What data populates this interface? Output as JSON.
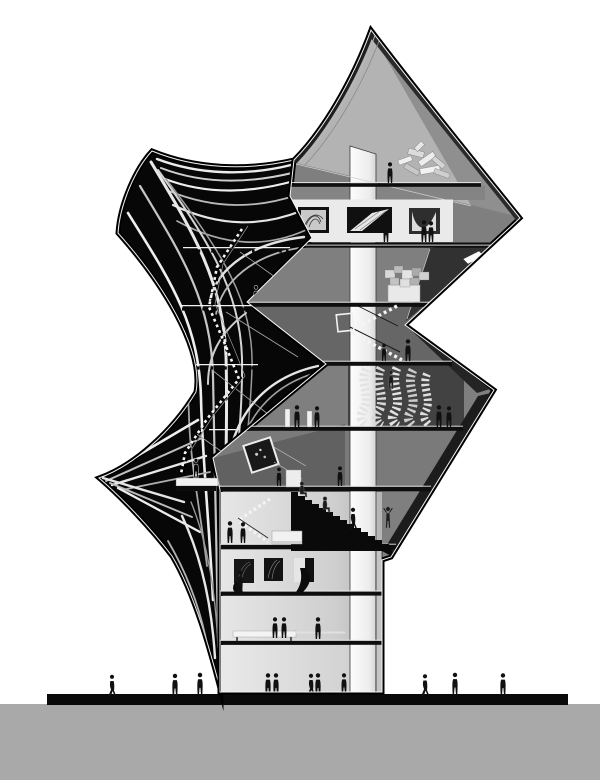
{
  "illustration": {
    "kind": "architectural-section",
    "style": "monochrome grayscale rendering",
    "building": "angular museum tower with draped cable canopy"
  },
  "palette": {
    "background": "#ffffff",
    "ground_plane": "#a9a9a9",
    "ground_line": "#0a0a0a",
    "canopy_fill": "#070707",
    "rib_light": "#e8e8e8",
    "volume_light_facet": "#b3b3b3",
    "volume_right_facet": "#8f8f8f",
    "gallery_band": "#eaeaea",
    "auditorium_bg": "#424242",
    "elevator_core": "#f7f7f7",
    "figure_ink": "#111111"
  },
  "scene": {
    "upper_volume_floors": [
      "roof sculpture gallery",
      "picture gallery with three framed works",
      "model display room",
      "switchback stair hall",
      "auditorium with waved seating rows",
      "installation room with tilted frame",
      "grand black stair"
    ],
    "tower_floors": [
      "stair lobby with reception desk",
      "small gallery with three dark artworks",
      "lounge with bench",
      "ground level hall"
    ],
    "artworks_in_band": 3,
    "artworks_in_tower_gallery": 3,
    "figures_indoor": 25,
    "figures_outdoor": 6,
    "canopy": "black shell with fanned white cable ribs, winding stair and left spike",
    "core": "continuous white elevator core"
  }
}
